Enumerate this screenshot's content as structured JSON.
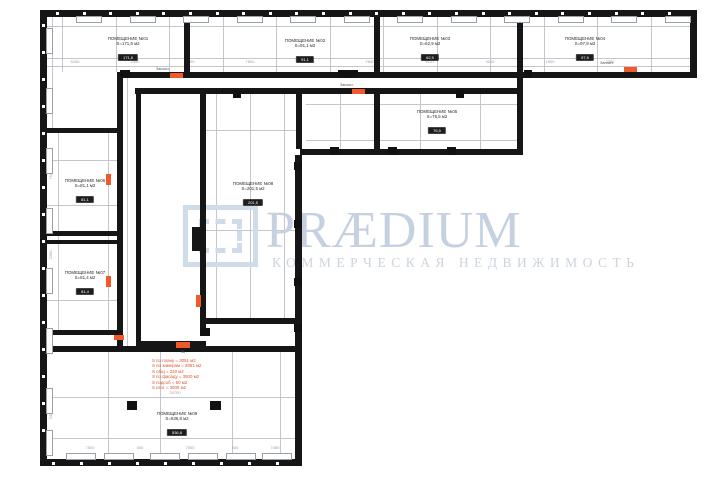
{
  "watermark": {
    "brand": "PRÆDIUM",
    "subtitle": "КОММЕРЧЕСКАЯ НЕДВИЖИМОСТЬ"
  },
  "colors": {
    "wall": "#161616",
    "grid_line": "#c3c7cd",
    "dim_text": "#9aa0a8",
    "accent_orange": "#f05a28",
    "red_annotation": "#d9542b",
    "watermark_blue": "#c5d1e1",
    "badge_bg": "#1d1d1d",
    "badge_text": "#ffffff"
  },
  "rooms": [
    {
      "name": "ПОМЕЩЕНИЕ №01",
      "area": "S=171,6 м2",
      "badge": "171,6"
    },
    {
      "name": "ПОМЕЩЕНИЕ №02",
      "area": "S=91,1 м2",
      "badge": "91,1"
    },
    {
      "name": "ПОМЕЩЕНИЕ №03",
      "area": "S=62,9 м2",
      "badge": "62,9"
    },
    {
      "name": "ПОМЕЩЕНИЕ №04",
      "area": "S=97,9 м2",
      "badge": "97,9"
    },
    {
      "name": "ПОМЕЩЕНИЕ №05",
      "area": "S=76,5 м2",
      "badge": "76,5"
    },
    {
      "name": "ПОМЕЩЕНИЕ №06",
      "area": "S=81,1 м2",
      "badge": "81,1"
    },
    {
      "name": "ПОМЕЩЕНИЕ №07",
      "area": "S=81,4 м2",
      "badge": "81,4"
    },
    {
      "name": "ПОМЕЩЕНИЕ №08",
      "area": "S=201,5 м2",
      "badge": "201,5"
    },
    {
      "name": "ПОМЕЩЕНИЕ №09",
      "area": "S=536,8 м2",
      "badge": "536,8"
    }
  ],
  "annotations": {
    "red_lines": [
      "S по плану = 3051 м2",
      "S по замерам = 3051 м2",
      "S общ = 220 м2",
      "S по фасаду = 3500 м2",
      "S подсоб = 50 м2",
      "S итог = 3000 м2"
    ],
    "exit_label": "Запасн.",
    "exit_label_short": "Зк"
  },
  "dimensions": {
    "top_row": [
      "2350",
      "2050",
      "2350",
      "2350",
      "2050",
      "2350",
      "2350",
      "2050",
      "2350",
      "2350",
      "2050",
      "2350"
    ],
    "mid_row": [
      "5280",
      "2350",
      "1200",
      "7500",
      "3050",
      "2640",
      "9121",
      "3210",
      "1500",
      "2350"
    ],
    "left_col": [
      "5280",
      "7500",
      "2350",
      "3050",
      "2450"
    ],
    "bottom_row": [
      "7500",
      "500",
      "7500",
      "500",
      "7460"
    ],
    "big_room_width": "24700"
  }
}
